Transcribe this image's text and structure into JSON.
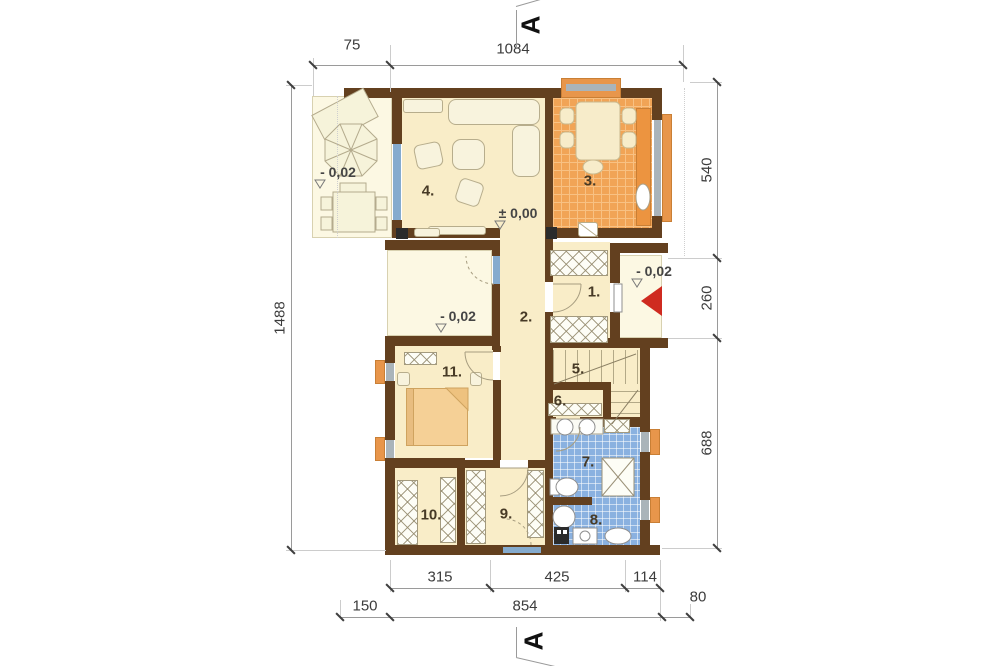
{
  "section_marker": "A",
  "rooms": {
    "r1": "1.",
    "r2": "2.",
    "r3": "3.",
    "r4": "4.",
    "r5": "5.",
    "r6": "6.",
    "r7": "7.",
    "r8": "8.",
    "r9": "9.",
    "r10": "10.",
    "r11": "11."
  },
  "levels": {
    "zero": "± 0,00",
    "terrace": "- 0,02",
    "patio": "- 0,02",
    "porch": "- 0,02"
  },
  "dims": {
    "top_left": "75",
    "top_main": "1084",
    "right_top": "540",
    "right_mid": "260",
    "right_bottom": "688",
    "left_total": "1488",
    "bottom_r1_a": "315",
    "bottom_r1_b": "425",
    "bottom_r1_c": "114",
    "bottom_r2_a": "150",
    "bottom_r2_b": "854",
    "bottom_r2_c": "80"
  },
  "colors": {
    "wall": "#63401f",
    "floor": "#f9edc8",
    "outdoor": "#fcf8e3",
    "kitchen_tile": "#f1a456",
    "bath_tile": "#8ab1e0",
    "window_glass": "#85abce",
    "sill": "#e8964b",
    "entrance_arrow": "#cf2b20"
  }
}
